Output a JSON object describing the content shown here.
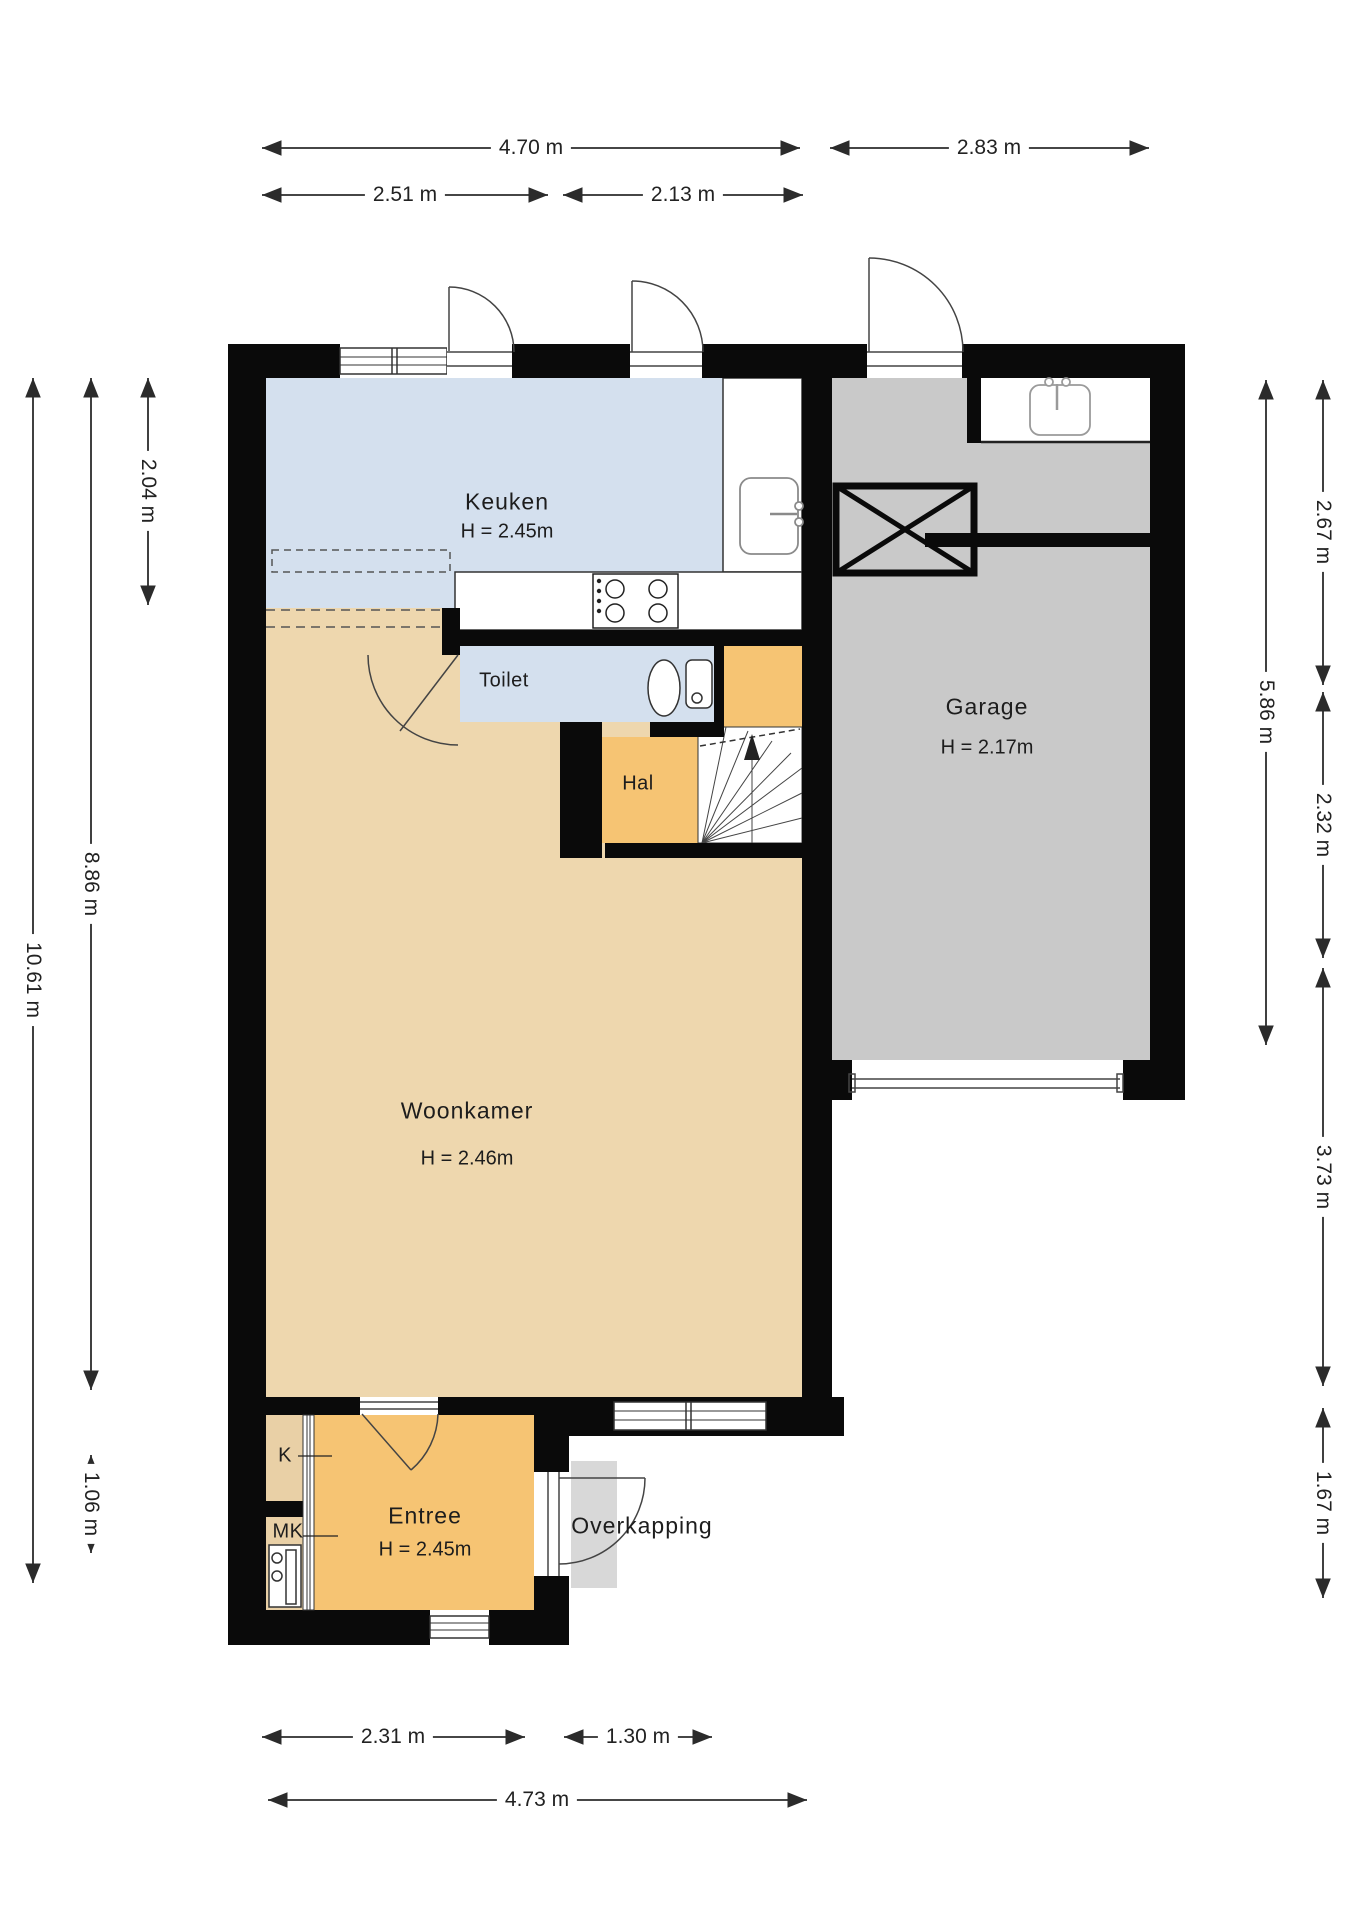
{
  "floorplan": {
    "rooms": {
      "keuken": {
        "name": "Keuken",
        "height": "H = 2.45m"
      },
      "garage": {
        "name": "Garage",
        "height": "H = 2.17m"
      },
      "toilet": {
        "name": "Toilet"
      },
      "hal": {
        "name": "Hal"
      },
      "woonkamer": {
        "name": "Woonkamer",
        "height": "H = 2.46m"
      },
      "entree": {
        "name": "Entree",
        "height": "H = 2.45m"
      },
      "kast": {
        "name": "K"
      },
      "meterkast": {
        "name": "MK"
      },
      "overkapping": {
        "name": "Overkapping"
      }
    },
    "dimensions": {
      "top": [
        {
          "label": "4.70 m"
        },
        {
          "label": "2.83 m"
        },
        {
          "label": "2.51 m"
        },
        {
          "label": "2.13 m"
        }
      ],
      "left": [
        {
          "label": "10.61 m"
        },
        {
          "label": "8.86 m"
        },
        {
          "label": "2.04 m"
        },
        {
          "label": "1.06 m"
        }
      ],
      "right": [
        {
          "label": "2.67 m"
        },
        {
          "label": "5.86 m"
        },
        {
          "label": "2.32 m"
        },
        {
          "label": "3.73 m"
        },
        {
          "label": "1.67 m"
        }
      ],
      "bottom": [
        {
          "label": "2.31 m"
        },
        {
          "label": "1.30 m"
        },
        {
          "label": "4.73 m"
        }
      ]
    },
    "colors": {
      "wall": "#0a0a0a",
      "keuken_floor": "#d4e0ee",
      "toilet_floor": "#d4e0ee",
      "woonkamer_floor": "#eed7ae",
      "hal_floor": "#f6c473",
      "entree_floor": "#f6c473",
      "kast_floor": "#e9d0a6",
      "garage_floor": "#c9c9c9",
      "overkapping_floor": "#d8d8d8",
      "dimension_line": "#2b2b2b"
    }
  }
}
